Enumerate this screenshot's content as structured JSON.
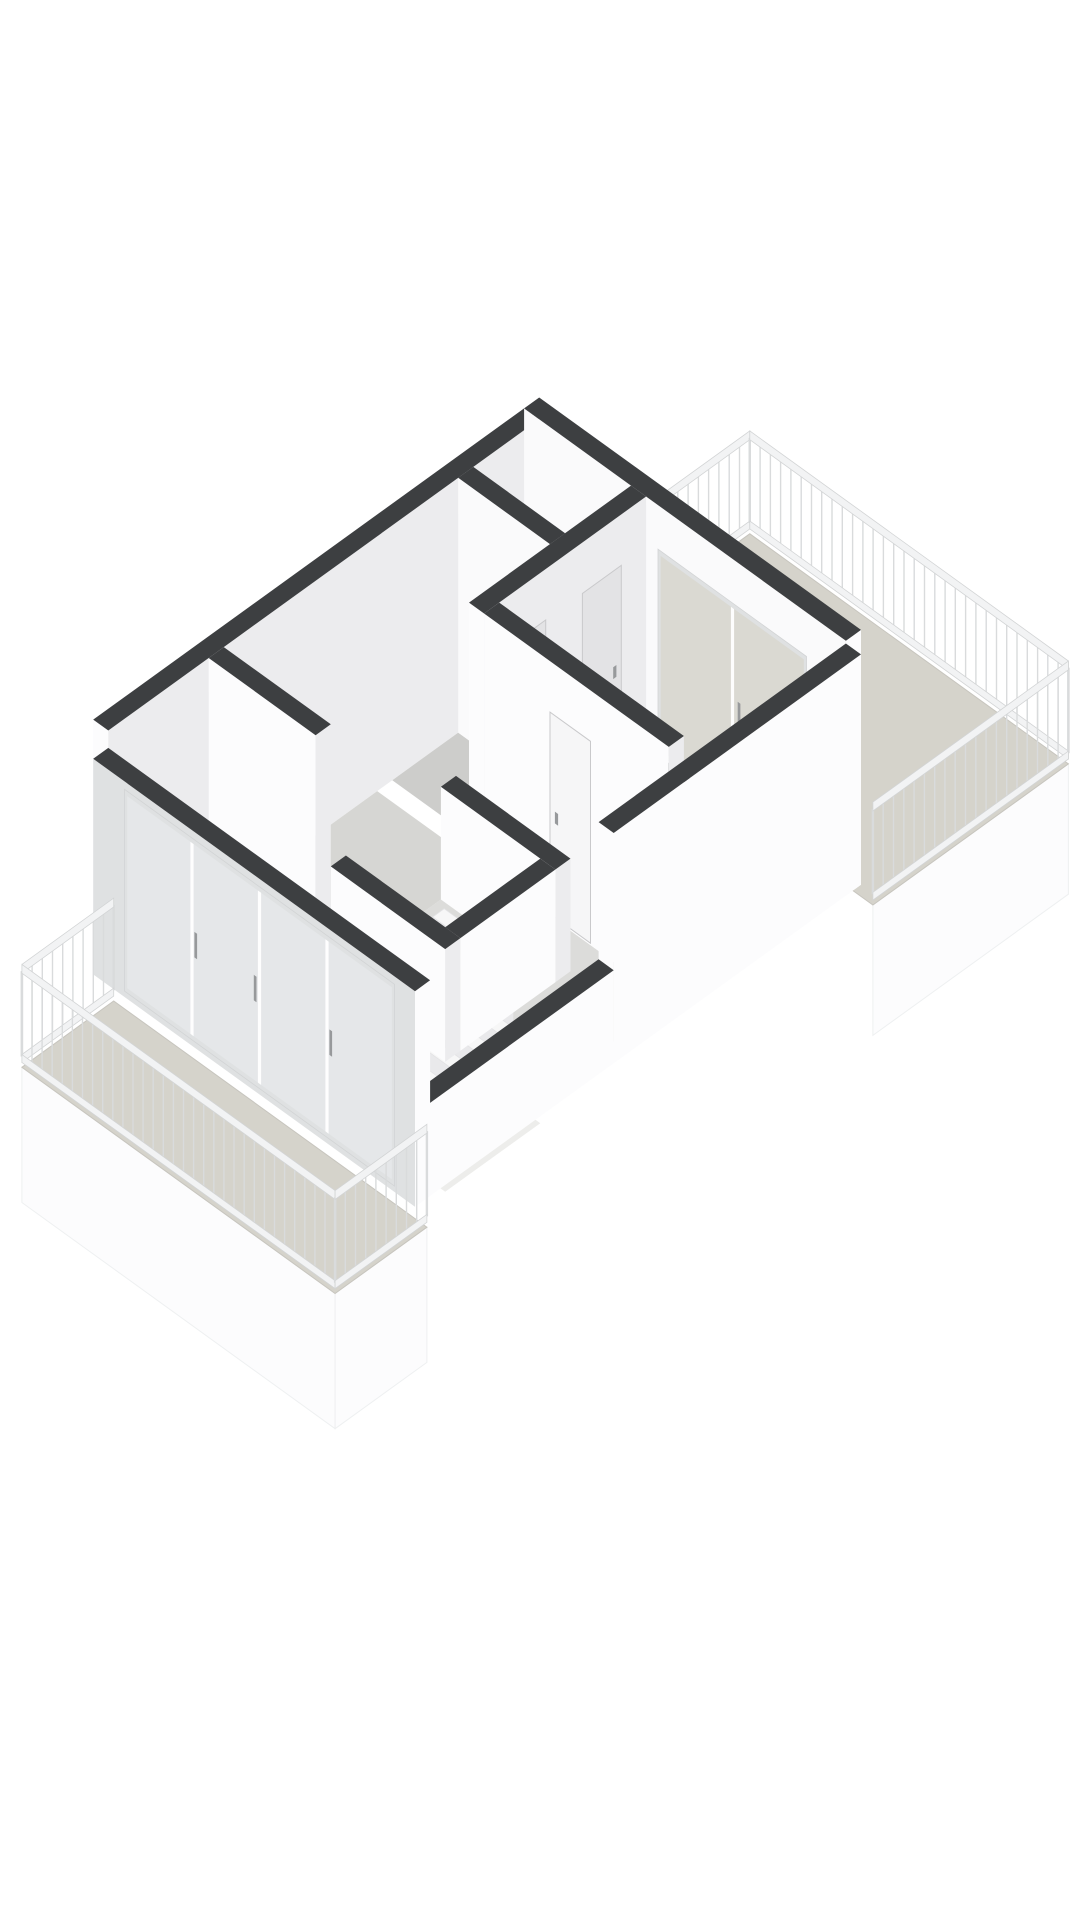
{
  "meta": {
    "page_background": "#ffffff",
    "figure": "3d-axonometric-floorplan",
    "visible_text": []
  },
  "colors": {
    "wall_top": "#3d3f41",
    "face_sw": "#fafafb",
    "face_se": "#ececee",
    "face_bright": "#fcfcfd",
    "face_shaded": "#e3e3e6",
    "floor_living": "#dcdcda",
    "floor_hall": "#d6d6d3",
    "floor_room": "#cdcdcb",
    "floor_bedroom": "#eae5db",
    "floor_terrace": "#d5d3cb",
    "floor_edge": "#c7c5be",
    "well_floor": "#ededeb",
    "tread": "#f7f7f7",
    "riser": "#e9e9eb",
    "glass": "#e9ecee",
    "glass_terrace": "#d9d8d1",
    "frame": "#dfe1e2",
    "mullion": "#ffffff",
    "rail_slat": "#d9dbdc",
    "rail_band": "#f2f3f4",
    "rail_stroke": "#d2d4d5",
    "fascia": "#fcfcfd",
    "fascia_stroke": "#eef0f1",
    "door_light": "#f6f6f7",
    "door_shaded": "#e3e3e5",
    "door_stroke": "#c9c9cb",
    "handle": "#97999b"
  },
  "projection": {
    "ox": 415,
    "oy": 1185,
    "kx": 54,
    "ky": 39,
    "kz": 98
  },
  "scene": [
    {
      "type": "face",
      "name": "terrace-fascia",
      "f": "b",
      "at": -0.5,
      "s1": 7.98,
      "s2": 11.6,
      "z1": -1.45,
      "z2": -0.12,
      "fill": "fascia",
      "stroke": "fascia_stroke"
    },
    {
      "type": "floor",
      "name": "terrace-floor",
      "r": [
        7.98,
        -0.5,
        11.6,
        5.4
      ],
      "z": -0.12,
      "fill": "floor_terrace",
      "stroke": "floor_edge"
    },
    {
      "type": "rail",
      "name": "terrace-railing-nw",
      "p1": [
        7.98,
        5.4
      ],
      "p2": [
        11.6,
        5.4
      ],
      "z0": -0.12,
      "h": 1.05
    },
    {
      "type": "rail",
      "name": "terrace-railing-ne",
      "p1": [
        11.6,
        5.4
      ],
      "p2": [
        11.6,
        -0.5
      ],
      "z0": -0.12,
      "h": 1.05
    },
    {
      "type": "rail",
      "name": "terrace-railing-se",
      "p1": [
        11.6,
        -0.5
      ],
      "p2": [
        7.98,
        -0.5
      ],
      "z0": -0.12,
      "h": 1.05
    },
    {
      "type": "wall",
      "name": "nw-facade-wall",
      "r": [
        -0.28,
        5.4,
        7.7,
        5.68
      ],
      "h": 2.6,
      "fa": "face_bright",
      "fb": "face_se"
    },
    {
      "type": "wall",
      "name": "ne-end-wall",
      "r": [
        7.7,
        -0.28,
        7.98,
        5.68
      ],
      "h": 2.6,
      "fa": "face_sw",
      "fb": "face_bright"
    },
    {
      "type": "glass",
      "name": "bedroom-terrace-window",
      "f": "a",
      "at": 7.7,
      "s1": 0.45,
      "s2": 3.2,
      "z1": 0.07,
      "z2": 2.15,
      "splits": [
        1.82
      ],
      "glass": "glass_terrace",
      "opacity": 0.95,
      "handles": [
        1.7
      ]
    },
    {
      "type": "glass",
      "name": "hall-slit-window",
      "f": "a",
      "at": 7.7,
      "s1": 4.0,
      "s2": 4.28,
      "z1": 0.1,
      "z2": 2.1,
      "splits": [],
      "glass": "glass_terrace",
      "opacity": 0.95,
      "handles": []
    },
    {
      "type": "floor",
      "name": "hall-floor",
      "r": [
        1.86,
        3.42,
        4.7,
        5.4
      ],
      "z": 0,
      "fill": "floor_hall"
    },
    {
      "type": "floor",
      "name": "small-room-a-floor",
      "r": [
        4.98,
        3.7,
        6.2,
        5.4
      ],
      "z": 0,
      "fill": "floor_room"
    },
    {
      "type": "floor",
      "name": "small-room-b-floor",
      "r": [
        6.48,
        3.7,
        7.7,
        5.4
      ],
      "z": 0,
      "fill": "floor_room"
    },
    {
      "type": "floor",
      "name": "bedroom-floor",
      "r": [
        4.98,
        0,
        7.7,
        3.42
      ],
      "z": 0,
      "fill": "floor_bedroom"
    },
    {
      "type": "floor",
      "name": "living-room-floor",
      "r": [
        0,
        0,
        4.7,
        3.42
      ],
      "z": 0,
      "fill": "floor_living"
    },
    {
      "type": "floor",
      "name": "living-room-floor-west",
      "r": [
        0,
        3.42,
        1.58,
        5.4
      ],
      "z": 0,
      "fill": "floor_living"
    },
    {
      "type": "wall",
      "name": "window-threshold-ne",
      "r": [
        7.6,
        0.2,
        7.7,
        3.3
      ],
      "h": 0.05,
      "fa": "wall_top",
      "fb": "wall_top"
    },
    {
      "type": "wall",
      "name": "window-threshold-sw",
      "r": [
        0,
        0,
        0.09,
        5.4
      ],
      "h": 0.05,
      "fa": "wall_top",
      "fb": "wall_top"
    },
    {
      "type": "wall",
      "name": "hall-west-wall",
      "r": [
        1.58,
        3.42,
        1.86,
        5.4
      ],
      "h": 2.6,
      "fa": "face_bright",
      "fb": "face_se"
    },
    {
      "type": "wall",
      "name": "small-rooms-divider-wall",
      "r": [
        6.2,
        3.7,
        6.48,
        5.4
      ],
      "h": 2.6,
      "fa": "face_sw",
      "fb": "face_se"
    },
    {
      "type": "wall",
      "name": "small-rooms-front-wall",
      "r": [
        4.7,
        3.42,
        7.7,
        3.7
      ],
      "h": 2.6,
      "fa": "face_bright",
      "fb": "face_se"
    },
    {
      "type": "door",
      "name": "small-room-a-door",
      "f": "b",
      "at": 3.42,
      "s1": 5.12,
      "s2": 5.84,
      "z2": 2.08,
      "fill": "door_shaded"
    },
    {
      "type": "door",
      "name": "small-room-b-door",
      "f": "b",
      "at": 3.42,
      "s1": 6.52,
      "s2": 7.24,
      "z2": 2.08,
      "fill": "door_shaded"
    },
    {
      "type": "wall",
      "name": "bedroom-separator-wall",
      "r": [
        4.7,
        0,
        4.98,
        3.42
      ],
      "h": 2.6,
      "fa": "face_bright",
      "fb": "face_se"
    },
    {
      "type": "door",
      "name": "bedroom-door",
      "f": "a",
      "at": 4.7,
      "s1": 1.45,
      "s2": 2.2,
      "z2": 2.08,
      "fill": "door_light"
    },
    {
      "type": "wall",
      "name": "stair-wall-ne",
      "r": [
        3.9,
        1.3,
        4.18,
        3.42
      ],
      "h": 1.15,
      "fa": "face_bright",
      "fb": "face_se"
    },
    {
      "type": "floor",
      "name": "stairwell-bottom",
      "r": [
        2.14,
        1.58,
        3.9,
        3.42
      ],
      "z": -1.55,
      "fill": "well_floor"
    },
    {
      "type": "steps",
      "name": "staircase",
      "aTop": 3.9,
      "n": 8,
      "da": 0.21,
      "dz": 0.185,
      "b1": 1.66,
      "b2": 3.36,
      "z0": -0.07
    },
    {
      "type": "wall",
      "name": "stair-wall-se",
      "r": [
        2.14,
        1.3,
        3.9,
        1.58
      ],
      "h": 1.15,
      "fa": "face_bright",
      "fb": "face_bright"
    },
    {
      "type": "wall",
      "name": "stair-wall-sw",
      "r": [
        1.86,
        1.3,
        2.14,
        3.42
      ],
      "h": 1.15,
      "fa": "face_bright",
      "fb": "face_se"
    },
    {
      "type": "wall",
      "name": "se-facade-tall",
      "r": [
        3.4,
        -0.28,
        7.98,
        0
      ],
      "h": 2.35,
      "fa": "face_bright",
      "fb": "face_bright"
    },
    {
      "type": "wall",
      "name": "se-facade-low",
      "r": [
        -0.28,
        -0.28,
        3.4,
        0
      ],
      "h": 0.95,
      "fa": "face_bright",
      "fb": "face_bright"
    },
    {
      "type": "wall",
      "name": "sw-glass-facade",
      "r": [
        -0.28,
        -0.28,
        0,
        5.68
      ],
      "h": 2.2,
      "fa": "frame",
      "fb": "face_bright"
    },
    {
      "type": "glass",
      "name": "sw-sliding-doors",
      "f": "a",
      "at": -0.28,
      "s1": 0.1,
      "s2": 5.1,
      "z1": 0.06,
      "z2": 2.12,
      "splits": [
        1.35,
        2.6,
        3.85
      ],
      "glass": "glass",
      "opacity": 0.55,
      "handles": [
        1.28,
        2.68,
        3.78
      ]
    },
    {
      "type": "face",
      "name": "balcony-fascia-sw",
      "f": "a",
      "at": -1.98,
      "s1": -0.5,
      "s2": 5.3,
      "z1": -1.5,
      "z2": -0.12,
      "fill": "fascia",
      "stroke": "fascia_stroke"
    },
    {
      "type": "face",
      "name": "balcony-fascia-se",
      "f": "b",
      "at": -0.5,
      "s1": -1.98,
      "s2": -0.28,
      "z1": -1.5,
      "z2": -0.12,
      "fill": "fascia",
      "stroke": "fascia_stroke"
    },
    {
      "type": "floor",
      "name": "balcony-floor",
      "r": [
        -1.98,
        -0.5,
        -0.28,
        5.3
      ],
      "z": -0.12,
      "fill": "floor_terrace",
      "stroke": "floor_edge"
    },
    {
      "type": "rail",
      "name": "balcony-railing-nw",
      "p1": [
        -1.98,
        5.3
      ],
      "p2": [
        -0.28,
        5.3
      ],
      "z0": -0.12,
      "h": 1.05
    },
    {
      "type": "rail",
      "name": "balcony-railing-sw",
      "p1": [
        -1.98,
        -0.5
      ],
      "p2": [
        -1.98,
        5.3
      ],
      "z0": -0.12,
      "h": 1.05
    },
    {
      "type": "rail",
      "name": "balcony-railing-se",
      "p1": [
        -1.98,
        -0.5
      ],
      "p2": [
        -0.28,
        -0.5
      ],
      "z0": -0.12,
      "h": 1.05
    }
  ]
}
